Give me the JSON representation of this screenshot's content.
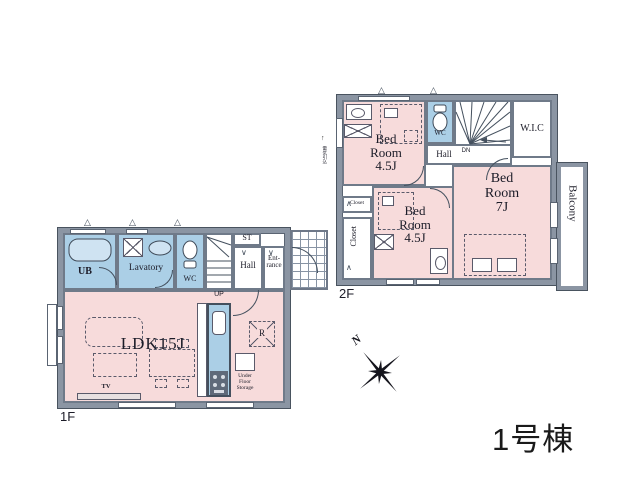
{
  "title": "1号棟",
  "compass": {
    "label": "N"
  },
  "floor1": {
    "label": "1F",
    "ub": "UB",
    "lavatory": "Lavatory",
    "wc": "WC",
    "st": "ST",
    "hall": "Hall",
    "entrance": [
      "Ent-",
      "rance"
    ],
    "stairs_dir": "UP",
    "ldk": "LDK15J",
    "tv": "TV",
    "fridge": "R",
    "under_floor_storage": [
      "Under",
      "Floor",
      "Storage"
    ]
  },
  "floor2": {
    "label": "2F",
    "bedroom_a": [
      "Bed",
      "Room",
      "4.5J"
    ],
    "bedroom_b": [
      "Bed",
      "Room",
      "4.5J"
    ],
    "bedroom_c": [
      "Bed",
      "Room",
      "7J"
    ],
    "wc": "WC",
    "wic": "W.I.C",
    "hall": "Hall",
    "stairs_dir": "DN",
    "closet_small": "Closet",
    "closet_tall": "Closet",
    "balcony": "Balcony",
    "service_note": "電気引込"
  },
  "colors": {
    "room_pink": "#f7dbdb",
    "room_blue": "#abcfe6",
    "wall_gray": "#8b95a3"
  }
}
